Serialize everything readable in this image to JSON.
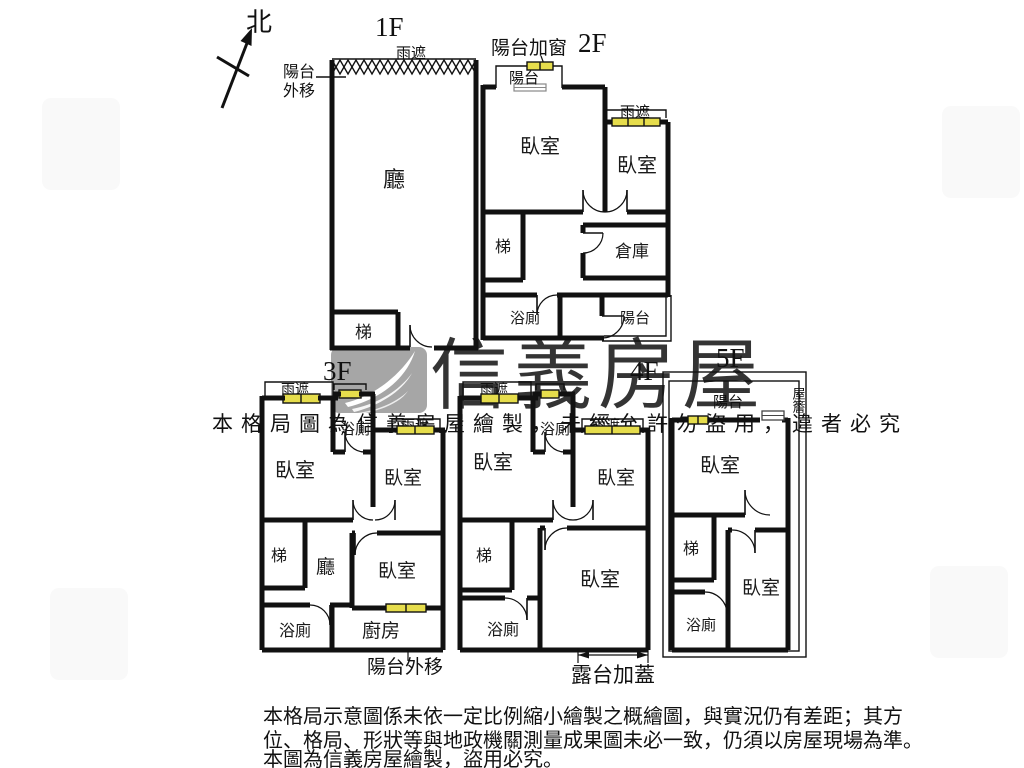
{
  "compass": {
    "north": "北"
  },
  "colors": {
    "wall": "#111111",
    "window_fill": "#e6dd4c",
    "brand_gray": "#9a9a9a",
    "notice_gray": "#cbcbcb"
  },
  "floor1": {
    "title": "1F",
    "canopy": "雨遮",
    "balcony_out_1": "陽台",
    "balcony_out_2": "外移",
    "living": "廳",
    "stairs": "梯"
  },
  "floor2": {
    "title": "2F",
    "balcony_window_note": "陽台加窗",
    "balcony_top": "陽台",
    "bedroom_left": "臥室",
    "bedroom_right": "臥室",
    "canopy": "雨遮",
    "stairs": "梯",
    "storage": "倉庫",
    "bath": "浴廁",
    "balcony_bottom": "陽台"
  },
  "floor3": {
    "title": "3F",
    "canopy_left": "雨遮",
    "canopy_right": "雨遮",
    "bedroom_left": "臥室",
    "bath_top": "浴廁",
    "bedroom_right": "臥室",
    "stairs": "梯",
    "living": "廳",
    "bedroom_mid": "臥室",
    "bath_bottom": "浴廁",
    "kitchen": "廚房",
    "note": "陽台外移"
  },
  "floor4": {
    "title": "4F",
    "canopy_left": "雨遮",
    "canopy_right": "雨遮",
    "bedroom_left": "臥室",
    "bath_top": "浴廁",
    "bedroom_right": "臥室",
    "stairs": "梯",
    "bedroom_big": "臥室",
    "bath_bottom": "浴廁",
    "note": "露台加蓋"
  },
  "floor5": {
    "title": "5F",
    "balcony": "陽台",
    "eave": "屋簷",
    "bedroom_top": "臥室",
    "stairs": "梯",
    "bedroom_bottom": "臥室",
    "bath": "浴廁"
  },
  "watermark": {
    "brand": "信義房屋",
    "notice": "本格局圖為信義房屋繪製，未經允許勿盜用，違者必究"
  },
  "disclaimer": {
    "line1": "本格局示意圖係未依一定比例縮小繪製之概繪圖，與實況仍有差距；其方",
    "line2": "位、格局、形狀等與地政機關測量成果圖未必一致，仍須以房屋現場為準。",
    "line3": "本圖為信義房屋繪製，盜用必究。"
  }
}
